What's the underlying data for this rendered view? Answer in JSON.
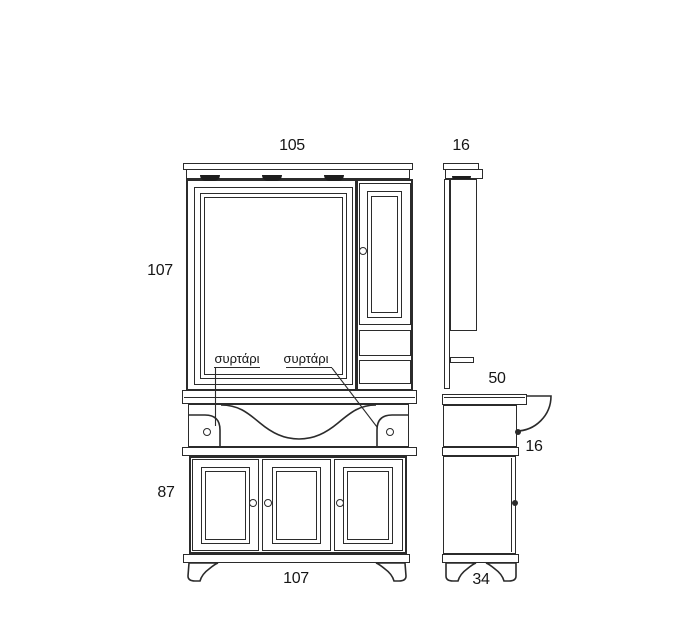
{
  "drawing": {
    "labels": {
      "left_drawer": "συρτάρι",
      "right_drawer": "συρτάρι"
    },
    "dims": {
      "front_width": "105",
      "side_depth_top": "16",
      "mirror_height": "107",
      "base_height": "87",
      "base_width": "107",
      "counter_depth": "50",
      "counter_thickness": "16",
      "side_depth_bottom": "34"
    },
    "colors": {
      "line": "#2b2b2b",
      "background": "#ffffff"
    }
  }
}
